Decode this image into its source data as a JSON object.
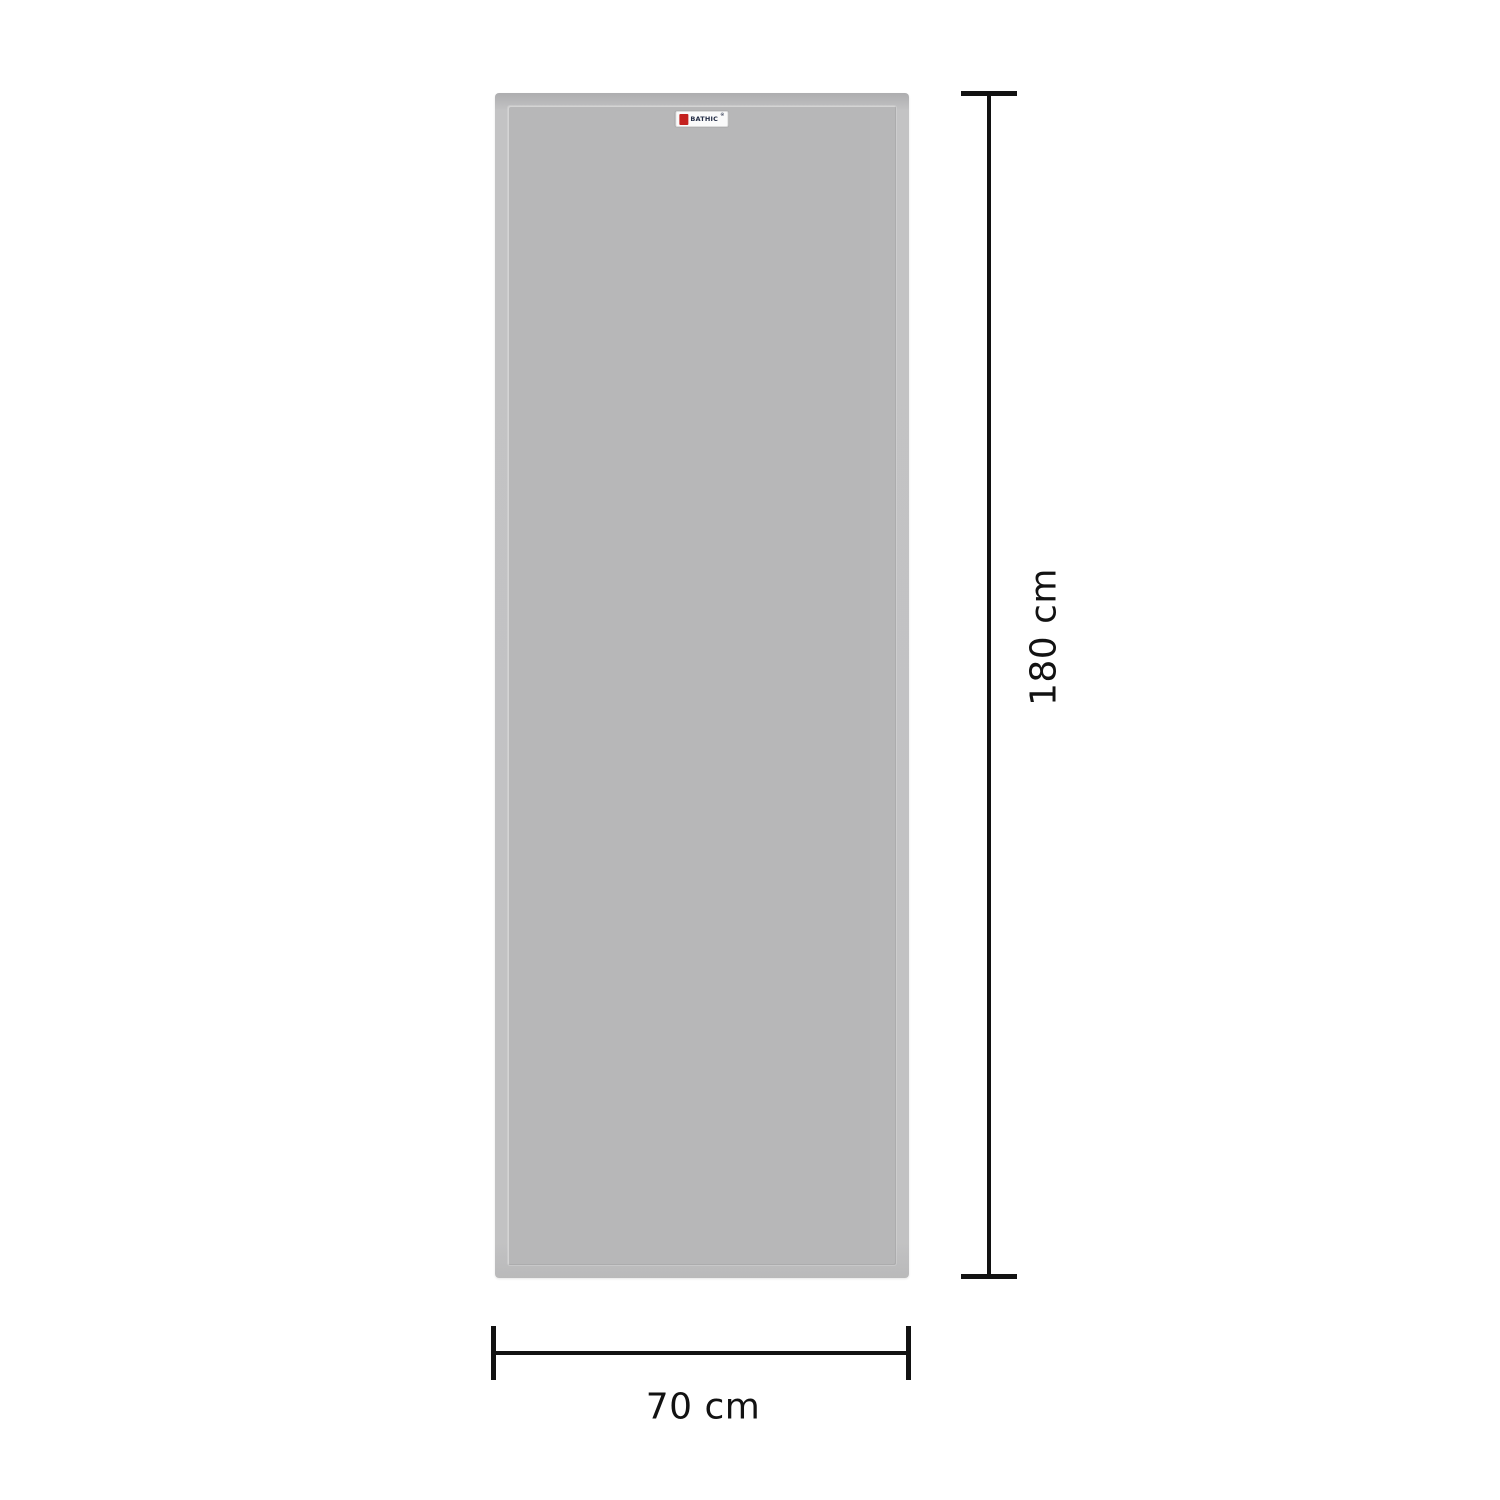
{
  "canvas": {
    "width_px": 1500,
    "height_px": 1500,
    "background": "#ffffff"
  },
  "product": {
    "type": "door-panel",
    "panel_fill_color": "#b7b7b8",
    "panel_edge_color": "#c2c2c3",
    "brand": {
      "name": "BATHIC",
      "registered_mark": "®",
      "logo_color": "#c4201e",
      "text_color": "#232c45",
      "label_background": "#fafafa"
    }
  },
  "dimensions": {
    "line_color": "#121212",
    "height": {
      "label": "180 cm"
    },
    "width": {
      "label": "70 cm"
    }
  }
}
